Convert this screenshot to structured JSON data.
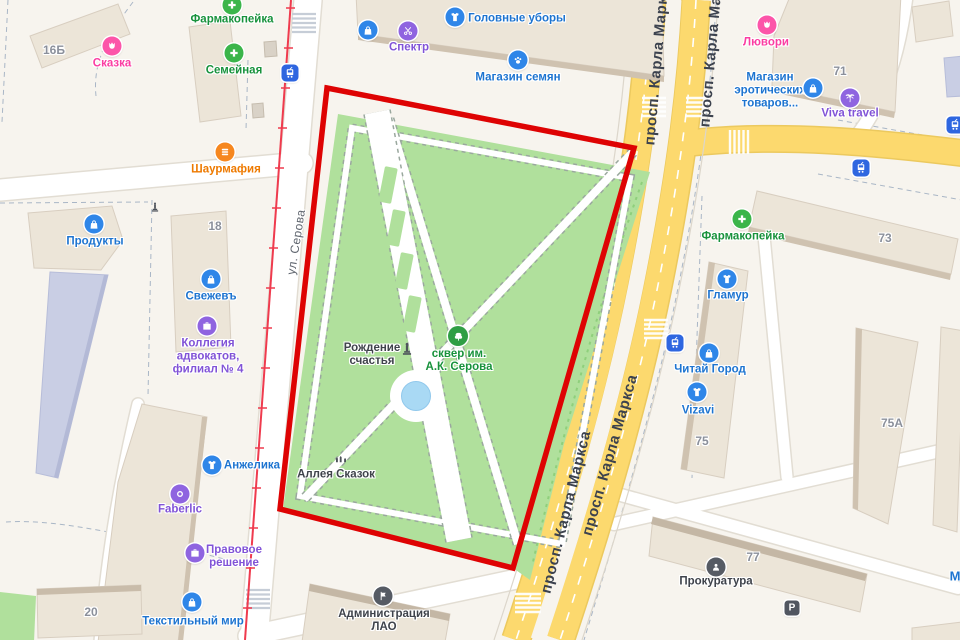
{
  "streets": {
    "serova": "ул. Серова",
    "karla_marksa": "просп. Карла Маркса"
  },
  "pois": {
    "skazka": {
      "label": "Сказка",
      "icon": "flower-icon",
      "color": "#fb3da2"
    },
    "farmakopeika_top": {
      "label": "Фармакопейка",
      "icon": "cross-icon",
      "color": "#18923c"
    },
    "semeynaya": {
      "label": "Семейная",
      "icon": "cross-icon",
      "color": "#18923c"
    },
    "golovnye_ubory": {
      "label": "Головные уборы",
      "icon": "tshirt-icon",
      "color": "#1d74d0"
    },
    "spektr": {
      "label": "Спектр",
      "icon": "scissors-icon",
      "color": "#8153d7"
    },
    "magazin_semyan": {
      "label": "Магазин семян",
      "icon": "paw-icon",
      "color": "#1d74d0"
    },
    "lyuvori": {
      "label": "Лювори",
      "icon": "flower-icon",
      "color": "#fb3da2"
    },
    "magazin_erot": {
      "label_lines": [
        "Магазин",
        "эротических",
        "товаров..."
      ],
      "icon": "bag-icon",
      "color": "#1d74d0"
    },
    "viva_travel": {
      "label": "Viva travel",
      "icon": "palm-icon",
      "color": "#8153d7"
    },
    "shaurmafia": {
      "label": "Шаурмафия",
      "icon": "burger-icon",
      "color": "#ee7a00"
    },
    "produkty": {
      "label": "Продукты",
      "icon": "bag-icon",
      "color": "#1d74d0"
    },
    "svezhev": {
      "label": "Свежевъ",
      "icon": "bag-icon",
      "color": "#1d74d0"
    },
    "kollegiya": {
      "label_lines": [
        "Коллегия",
        "адвокатов,",
        "филиал № 4"
      ],
      "icon": "briefcase-icon",
      "color": "#8153d7"
    },
    "farmakopeika_right": {
      "label": "Фармакопейка",
      "icon": "cross-icon",
      "color": "#18923c"
    },
    "glamur": {
      "label": "Гламур",
      "icon": "tshirt-icon",
      "color": "#1d74d0"
    },
    "chitay_gorod": {
      "label": "Читай Город",
      "icon": "bag-icon",
      "color": "#1d74d0"
    },
    "vizavi": {
      "label": "Vizavi",
      "icon": "tshirt-icon",
      "color": "#1d74d0"
    },
    "prokuratura": {
      "label": "Прокуратура",
      "icon": "emblem-icon",
      "color": "#3f434b"
    },
    "anzhelika": {
      "label": "Анжелика",
      "icon": "tshirt-icon",
      "color": "#1d74d0"
    },
    "faberlic": {
      "label": "Faberlic",
      "icon": "ring-icon",
      "color": "#8153d7"
    },
    "pravovoe": {
      "label_lines": [
        "Правовое",
        "решение"
      ],
      "icon": "briefcase-icon",
      "color": "#8153d7"
    },
    "tekstilny_mir": {
      "label": "Текстильный мир",
      "icon": "bag-icon",
      "color": "#1d74d0"
    },
    "administratsiya": {
      "label_lines": [
        "Администрация",
        "ЛАО"
      ],
      "icon": "flag-icon",
      "color": "#3f434b"
    },
    "rozhdenie": {
      "label_lines": [
        "Рождение",
        "счастья"
      ],
      "icon": "monument-icon",
      "color": "#3f434b"
    },
    "skver": {
      "label_lines": [
        "сквер им.",
        "А.К. Серова"
      ],
      "icon": "tree-icon",
      "color": "#18923c"
    },
    "alleya": {
      "label": "Аллея Сказок",
      "icon": "statues-icon",
      "color": "#3f434b"
    }
  },
  "numbers": {
    "b16": "16Б",
    "b18": "18",
    "b20": "20",
    "b71": "71",
    "b73": "73",
    "b75": "75",
    "b75a": "75А",
    "b77": "77"
  },
  "misc": {
    "parking": "P",
    "partial_m": "М"
  },
  "colors": {
    "selection_boundary": "#de0303",
    "park_green": "#b0e09c",
    "road_yellow": "#fcd96e",
    "tram_line": "#ef3b4e",
    "pond_blue": "#a9d9f4",
    "poi_blue": "#2f86e8",
    "poi_purple": "#8f64e0",
    "poi_green": "#3bb54a",
    "poi_pink": "#fc55a9",
    "poi_orange": "#f6871f",
    "transit_blue": "#2e66e0"
  }
}
